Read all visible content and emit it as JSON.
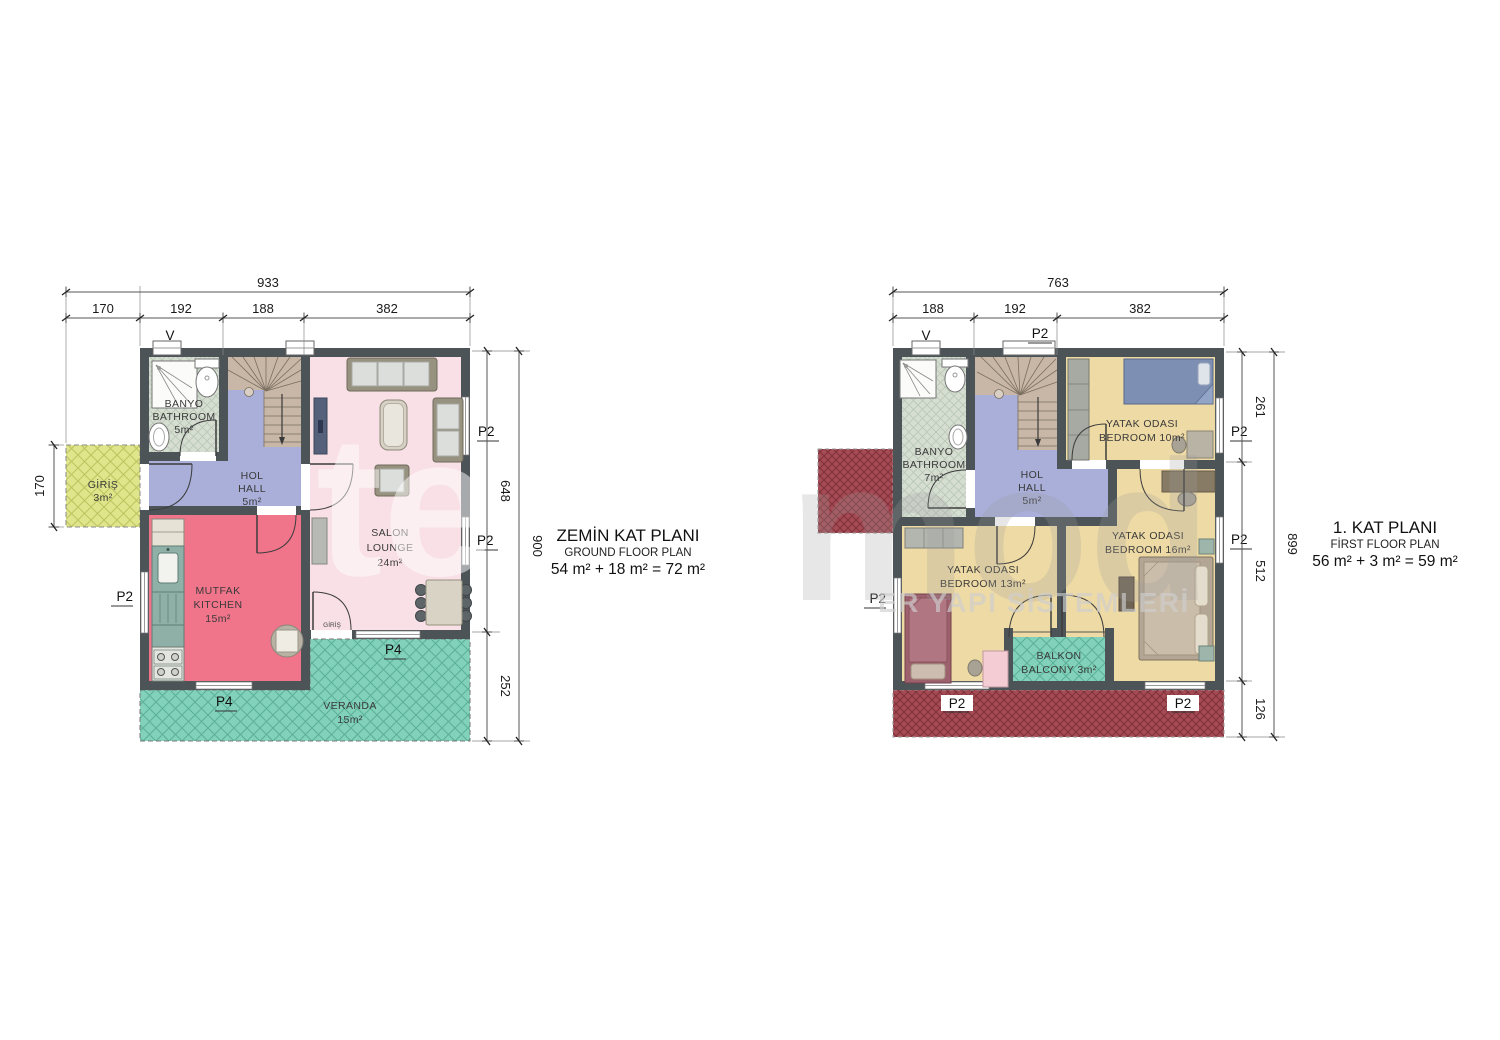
{
  "watermark": {
    "left_glyphs": "te",
    "right_glyphs": "mod",
    "tagline": "ER YAPI SİSTEMLERİ"
  },
  "ground_floor": {
    "title": "ZEMİN KAT PLANI",
    "subtitle": "GROUND FLOOR PLAN",
    "area_formula": "54 m² + 18 m² = 72 m²",
    "dims": {
      "total_width": "933",
      "seg1": "170",
      "seg2": "192",
      "seg3": "188",
      "seg4": "382",
      "porch_depth": "170",
      "right_upper": "648",
      "right_lower": "252",
      "right_total": "900"
    },
    "rooms": {
      "entrance": {
        "line1": "GİRİŞ",
        "line2": "3m²"
      },
      "bathroom": {
        "line1": "BANYO",
        "line2": "BATHROOM",
        "line3": "5m²"
      },
      "hall": {
        "line1": "HOL",
        "line2": "HALL",
        "line3": "5m²"
      },
      "lounge": {
        "line1": "SALON",
        "line2": "LOUNGE",
        "line3": "24m²"
      },
      "kitchen": {
        "line1": "MUTFAK",
        "line2": "KITCHEN",
        "line3": "15m²"
      },
      "veranda": {
        "line1": "VERANDA",
        "line2": "15m²"
      }
    },
    "openings": {
      "vent": "V",
      "window_right_upper": "P2",
      "window_right_lower": "P2",
      "window_left": "P2",
      "window_salon": "P4",
      "window_kitchen": "P4",
      "veranda_door": "GİRİŞ"
    }
  },
  "first_floor": {
    "title": "1. KAT PLANI",
    "subtitle": "FİRST FLOOR PLAN",
    "area_formula": "56 m² + 3 m² = 59 m²",
    "dims": {
      "total_width": "763",
      "seg1": "188",
      "seg2": "192",
      "seg3": "382",
      "right_upper": "261",
      "right_middle": "512",
      "right_lower": "126",
      "right_total": "899"
    },
    "rooms": {
      "bathroom": {
        "line1": "BANYO",
        "line2": "BATHROOM",
        "line3": "7m²"
      },
      "hall": {
        "line1": "HOL",
        "line2": "HALL",
        "line3": "5m²"
      },
      "bedroom_10": {
        "line1": "YATAK ODASI",
        "line2": "BEDROOM 10m²"
      },
      "bedroom_16": {
        "line1": "YATAK ODASI",
        "line2": "BEDROOM 16m²"
      },
      "bedroom_13": {
        "line1": "YATAK ODASI",
        "line2": "BEDROOM 13m²"
      },
      "balcony": {
        "line1": "BALKON",
        "line2": "BALCONY 3m²"
      }
    },
    "openings": {
      "vent": "V",
      "window_top": "P2",
      "window_right_upper": "P2",
      "window_right_lower": "P2",
      "window_left": "P2",
      "roof_left": "P2",
      "roof_right": "P2"
    }
  },
  "colors": {
    "wall": "#4d5458",
    "bathroom": "#d6ded2",
    "hall": "#a9afd9",
    "stairs": "#c8b6a6",
    "lounge": "#f8e0e6",
    "kitchen": "#f0758b",
    "bedroom": "#eedaa4",
    "veranda": "#82d1ba",
    "porch": "#dfe58b",
    "roof": "#a54b54"
  }
}
